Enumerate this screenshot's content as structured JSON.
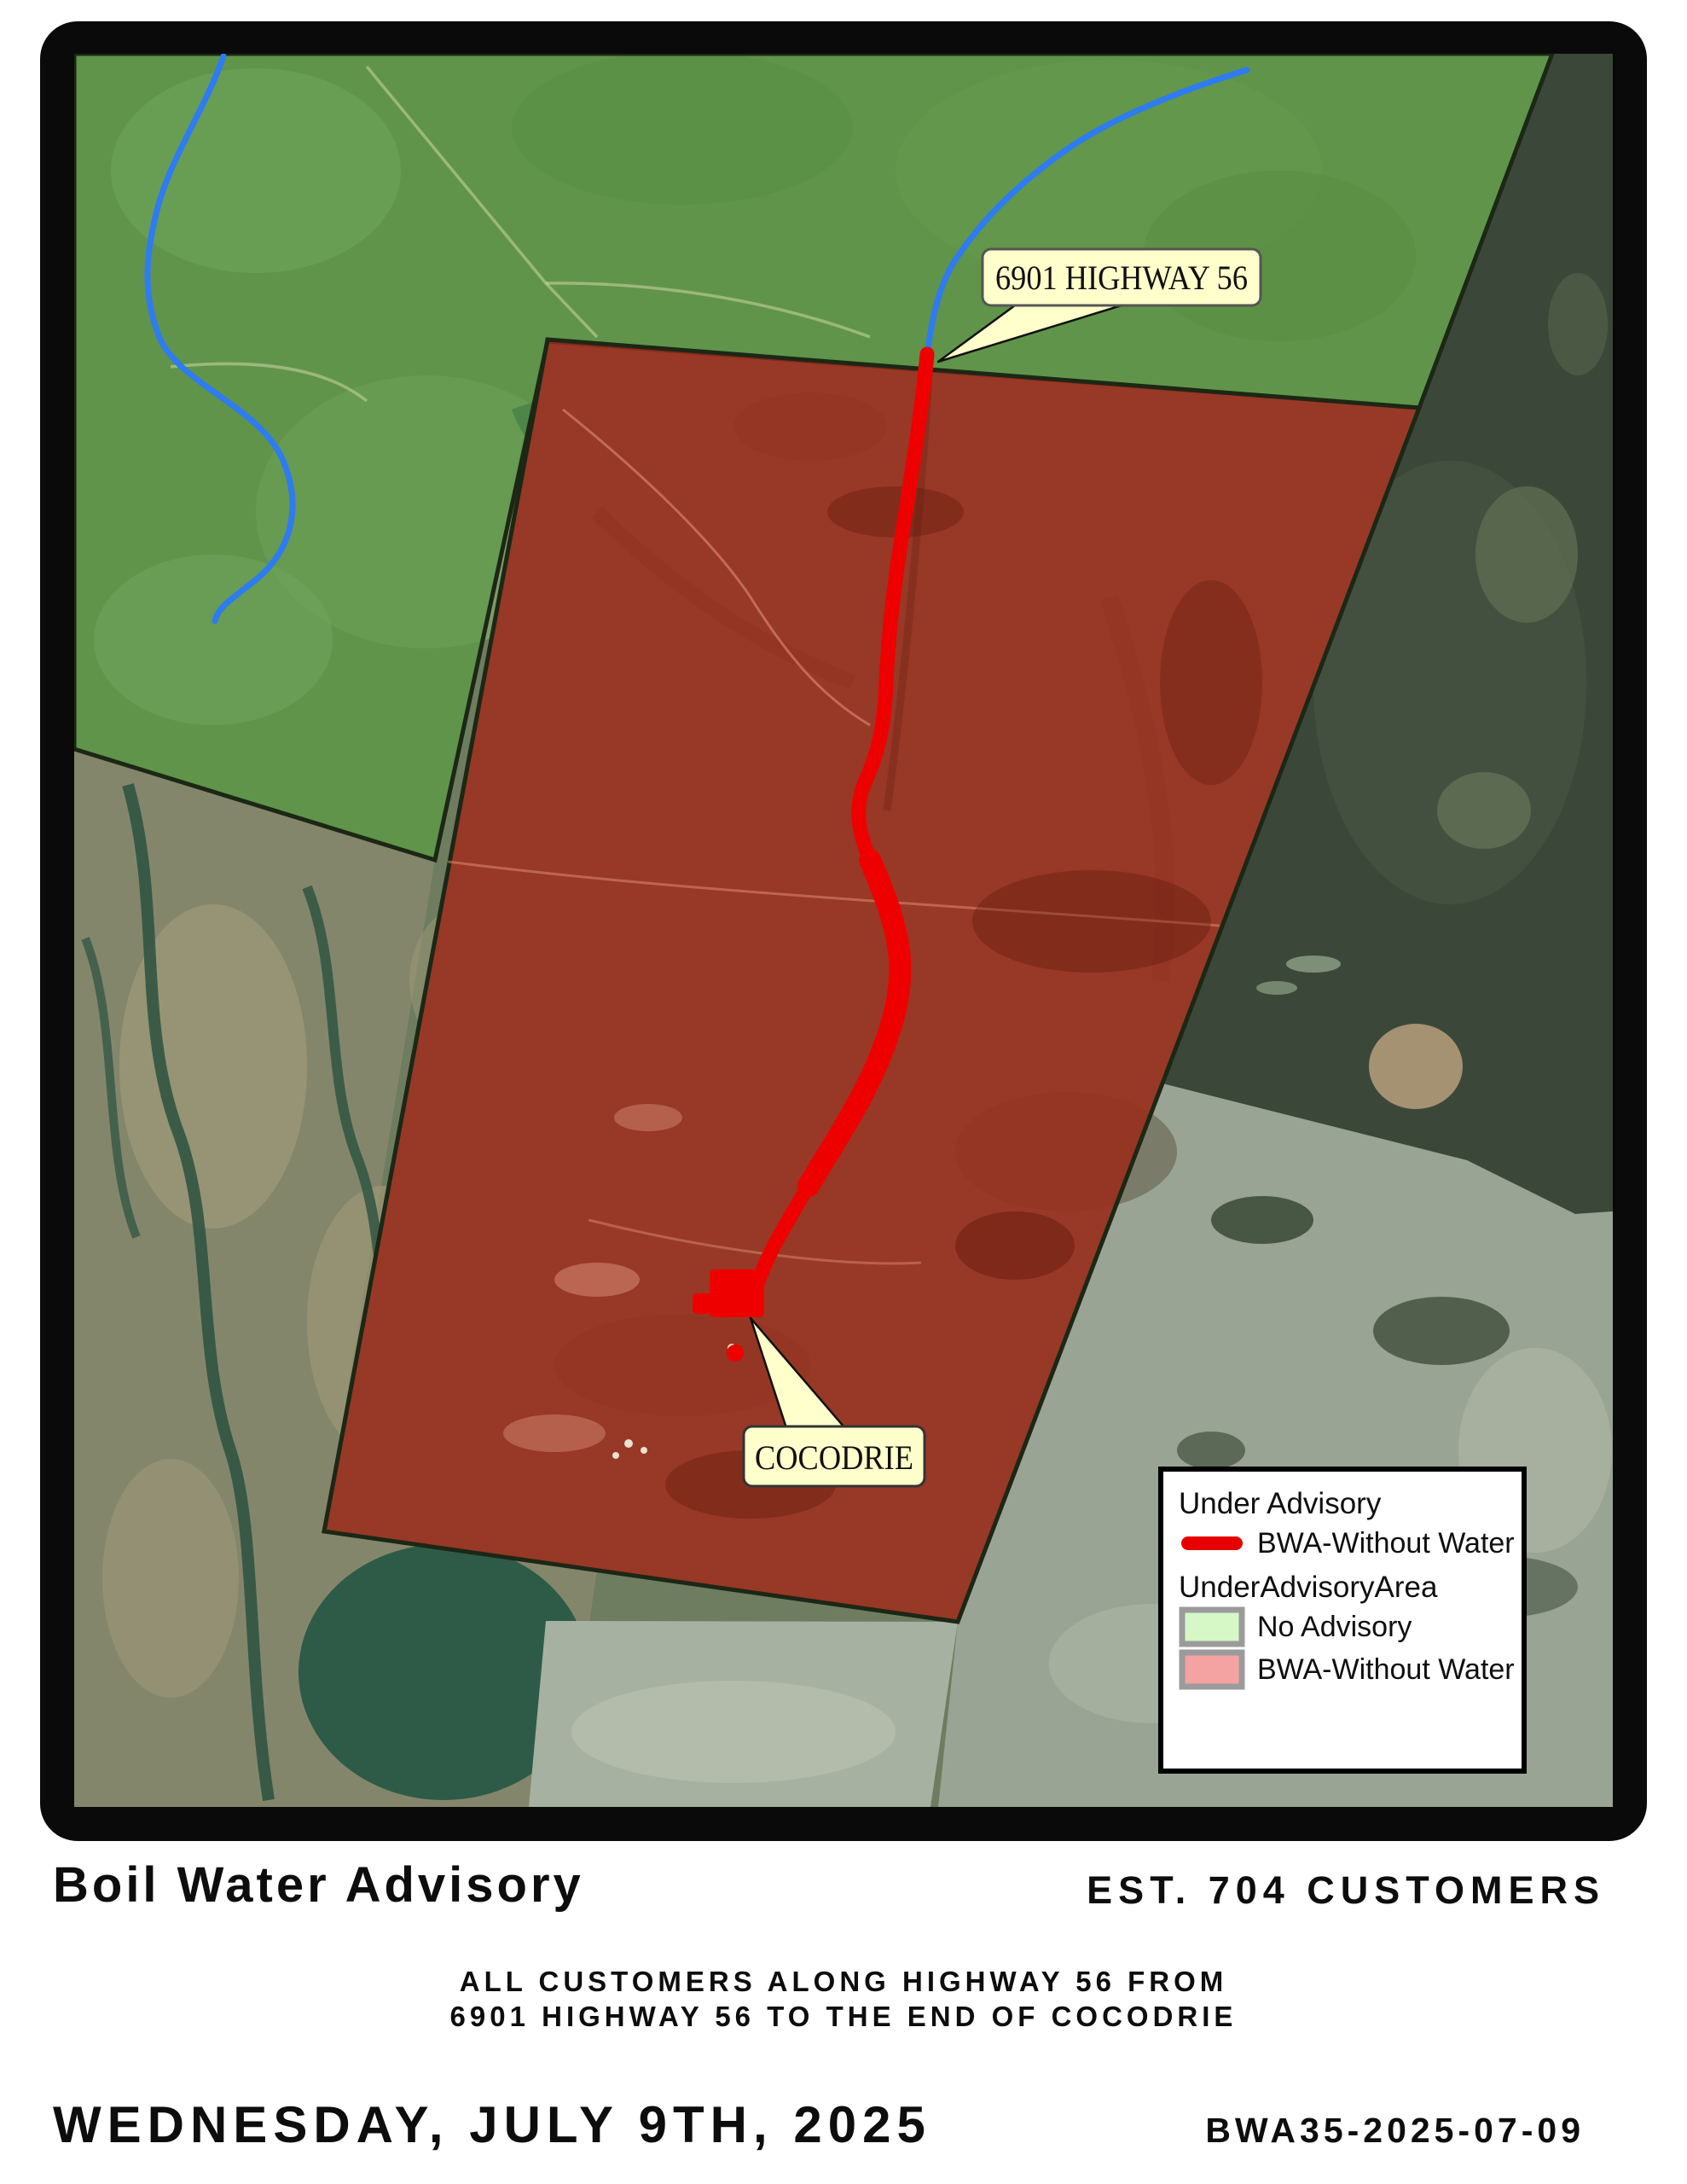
{
  "map": {
    "callouts": {
      "highway": "6901 HIGHWAY 56",
      "cocodrie": "COCODRIE"
    },
    "watermark_fragment": "or",
    "colors": {
      "route_red": "#ee0000",
      "river_blue": "#2e7bf2",
      "advisory_area_red": "#a02b1a",
      "no_advisory_green": "#3f8230",
      "boundary_dark": "#1c2715",
      "callout_fill": "#ffffcc"
    }
  },
  "legend": {
    "line_group_title": "Under Advisory",
    "line_item_label": "BWA-Without Water",
    "line_color": "#e60000",
    "area_group_title": "UnderAdvisoryArea",
    "swatch_border": "#9b9b9b",
    "area_items": [
      {
        "label": "No Advisory",
        "color": "#d6f7c6"
      },
      {
        "label": "BWA-Without Water",
        "color": "#f5a2a2"
      }
    ]
  },
  "footer": {
    "title": "Boil Water Advisory",
    "customers": "EST. 704 CUSTOMERS",
    "advisory_line1": "ALL CUSTOMERS ALONG HIGHWAY 56 FROM",
    "advisory_line2": "6901 HIGHWAY 56 TO THE END OF COCODRIE",
    "date": "WEDNESDAY, JULY 9TH, 2025",
    "reference": "BWA35-2025-07-09"
  }
}
